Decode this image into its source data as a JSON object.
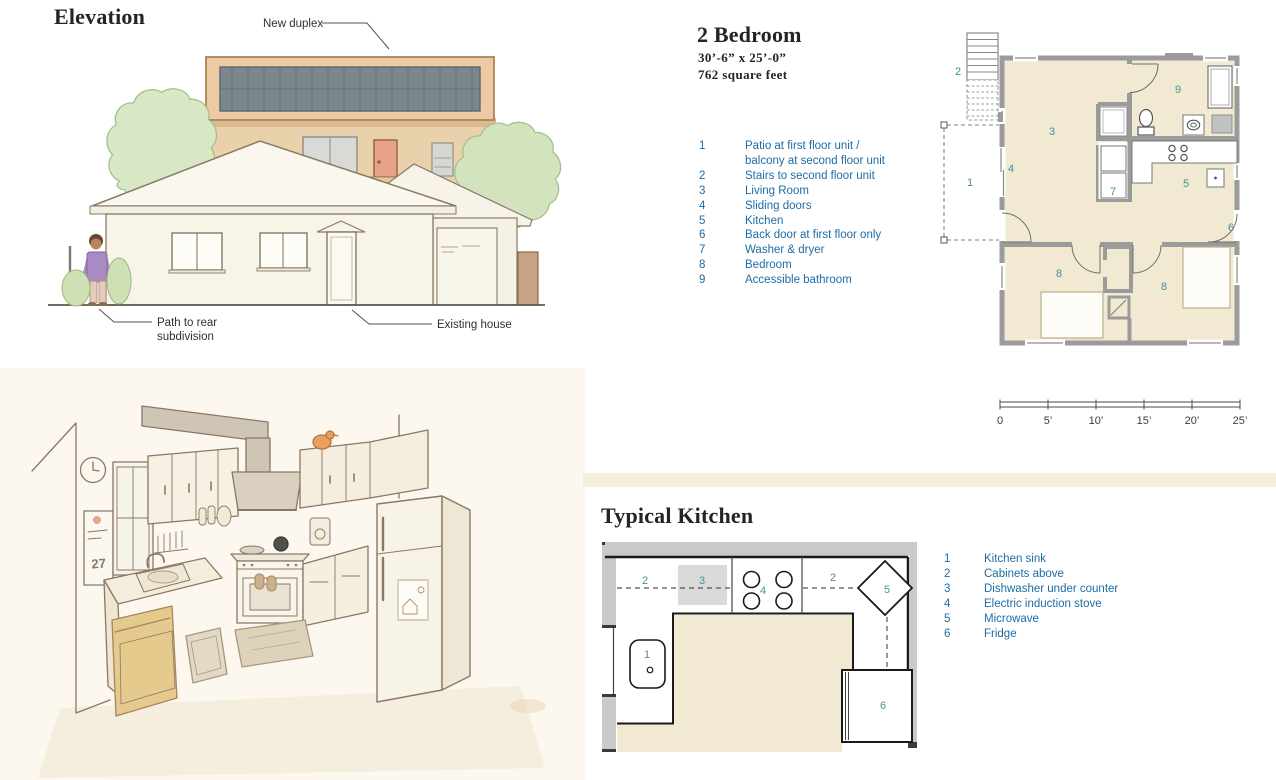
{
  "page": {
    "width": 1276,
    "height": 780,
    "background": "#ffffff"
  },
  "elevation": {
    "title": "Elevation",
    "callouts": {
      "new_duplex": "New duplex",
      "path_line1": "Path to rear",
      "path_line2": "subdivision",
      "existing_house": "Existing house"
    }
  },
  "two_bedroom": {
    "title": "2 Bedroom",
    "dimensions": "30’-6”  x  25’-0”",
    "area": "762 square feet",
    "legend": [
      {
        "num": "1",
        "label": "Patio at first floor unit /"
      },
      {
        "num": "",
        "label": "balcony at second floor unit"
      },
      {
        "num": "2",
        "label": "Stairs to second floor unit"
      },
      {
        "num": "3",
        "label": "Living Room"
      },
      {
        "num": "4",
        "label": "Sliding doors"
      },
      {
        "num": "5",
        "label": "Kitchen"
      },
      {
        "num": "6",
        "label": "Back door at first floor only"
      },
      {
        "num": "7",
        "label": "Washer & dryer"
      },
      {
        "num": "8",
        "label": "Bedroom"
      },
      {
        "num": "9",
        "label": "Accessible bathroom"
      }
    ],
    "plan_labels": {
      "patio": "1",
      "stairs": "2",
      "living": "3",
      "sliding": "4",
      "kitchen": "5",
      "back_door": "6",
      "washer": "7",
      "bedroom_left": "8",
      "bedroom_right": "8",
      "bathroom": "9"
    },
    "scale_ticks": [
      "0",
      "5’",
      "10’",
      "15’",
      "20’",
      "25’"
    ]
  },
  "typical_kitchen": {
    "title": "Typical Kitchen",
    "legend": [
      {
        "num": "1",
        "label": "Kitchen sink"
      },
      {
        "num": "2",
        "label": "Cabinets above"
      },
      {
        "num": "3",
        "label": "Dishwasher under counter"
      },
      {
        "num": "4",
        "label": "Electric induction stove"
      },
      {
        "num": "5",
        "label": "Microwave"
      },
      {
        "num": "6",
        "label": "Fridge"
      }
    ],
    "plan_labels": {
      "sink": "1",
      "cabinets_left": "2",
      "cabinets_right": "2",
      "dishwasher": "3",
      "stove": "4",
      "microwave": "5",
      "fridge": "6"
    }
  },
  "kitchen_illustration": {
    "calendar_date": "27"
  },
  "colors": {
    "legend_blue": "#1d6ca6",
    "plan_number_teal": "#42909a",
    "floor_beige": "#f2e9d2",
    "wall_gray": "#9b9b9b",
    "divider_band": "#f6efdc",
    "kitchen_band_gray": "#c9c9c9",
    "title_ink": "#262320",
    "duplex_tan": "#eecaa4",
    "duplex_window_band": "#7a878c"
  }
}
